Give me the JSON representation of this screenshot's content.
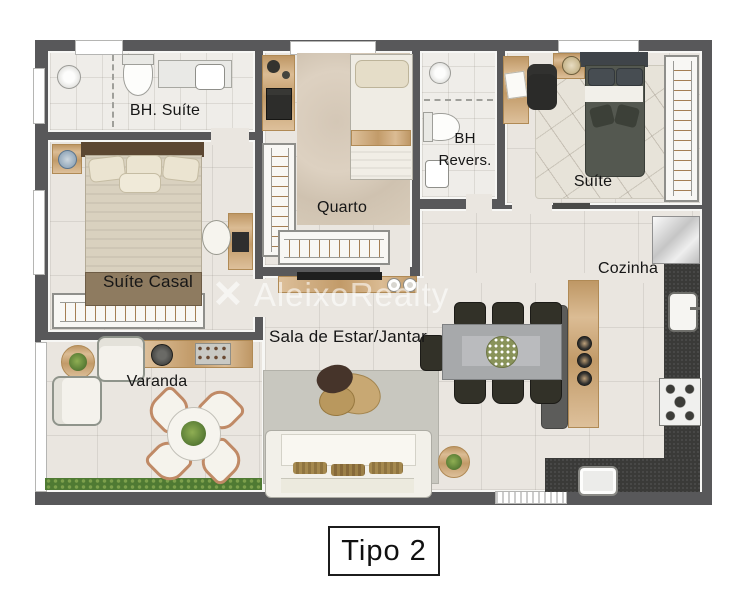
{
  "title": "Tipo 2",
  "watermark": "AleixoRealty",
  "rooms": {
    "bh_suite": "BH. Suíte",
    "suite_casal": "Suíte Casal",
    "varanda": "Varanda",
    "quarto": "Quarto",
    "bh_revers_l1": "BH",
    "bh_revers_l2": "Revers.",
    "suite": "Suíte",
    "cozinha": "Cozinha",
    "sala": "Sala de Estar/Jantar"
  },
  "colors": {
    "wall": "#58585a",
    "floor": "#eae6e0",
    "floor_bath": "#efede9",
    "wood": "#d2ab79",
    "counter_dark": "#3a3a38",
    "furniture_white": "#f3f1ea",
    "bed_dark": "#545850",
    "rug": "#c8c7bf",
    "plant": "#5e8138",
    "copper": "#c08a66",
    "label_text": "#161616",
    "watermark": "rgba(255,255,255,0.58)"
  }
}
